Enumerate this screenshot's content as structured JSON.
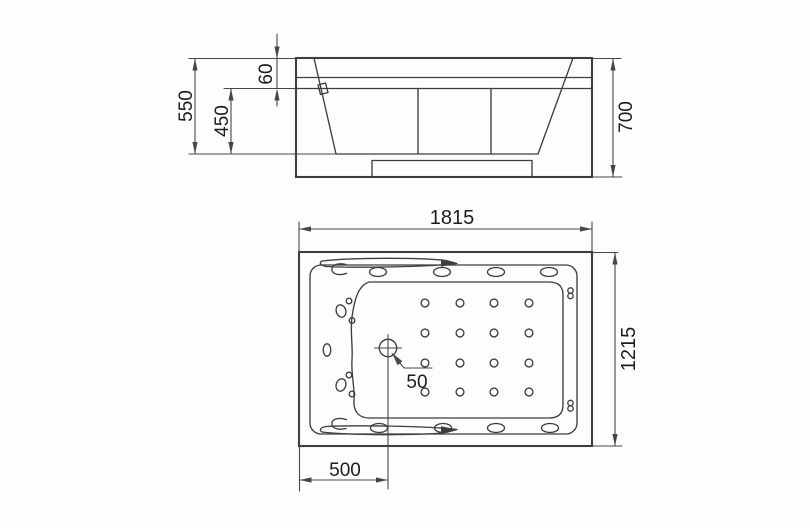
{
  "colors": {
    "line": "#3e3e3e",
    "dim": "#474747",
    "text": "#1c1c1c",
    "background": "#fdfdfd"
  },
  "views": {
    "side": {
      "name": "side-elevation",
      "dims": {
        "overall_height": "550",
        "rim_height": "60",
        "basin_depth": "450",
        "total_height": "700"
      }
    },
    "plan": {
      "name": "top-plan",
      "dims": {
        "length": "1815",
        "width": "1215",
        "drain_diameter": "50",
        "drain_offset": "500"
      }
    }
  }
}
